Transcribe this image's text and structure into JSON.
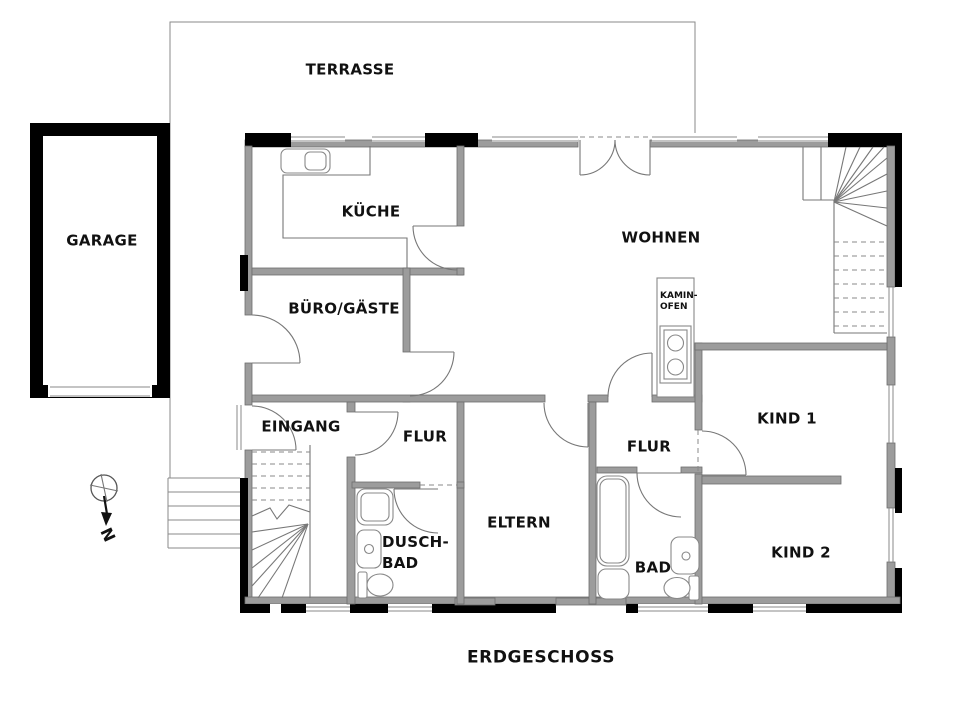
{
  "floor_label": "ERDGESCHOSS",
  "rooms": {
    "terrasse": "TERRASSE",
    "garage": "GARAGE",
    "kueche": "KÜCHE",
    "wohnen": "WOHNEN",
    "buero_gaeste": "BÜRO/GÄSTE",
    "eingang": "EINGANG",
    "flur_west": "FLUR",
    "flur_east": "FLUR",
    "eltern": "ELTERN",
    "dusch_bad": "DUSCH-\nBAD",
    "bad": "BAD",
    "kind1": "KIND 1",
    "kind2": "KIND 2",
    "kamin_ofen": "KAMIN-\nOFEN"
  },
  "compass": {
    "north_label": "N"
  },
  "colors": {
    "wall_gray": "#9c9c9c",
    "wall_black": "#000000",
    "line": "#777777",
    "background": "#ffffff"
  },
  "icons": {
    "compass": "north-arrow-icon",
    "sink": "kitchen-sink-icon",
    "stove": "stove-icon",
    "bathtub": "bathtub-icon",
    "shower": "shower-icon",
    "toilet": "toilet-icon",
    "washbasin": "washbasin-icon"
  }
}
